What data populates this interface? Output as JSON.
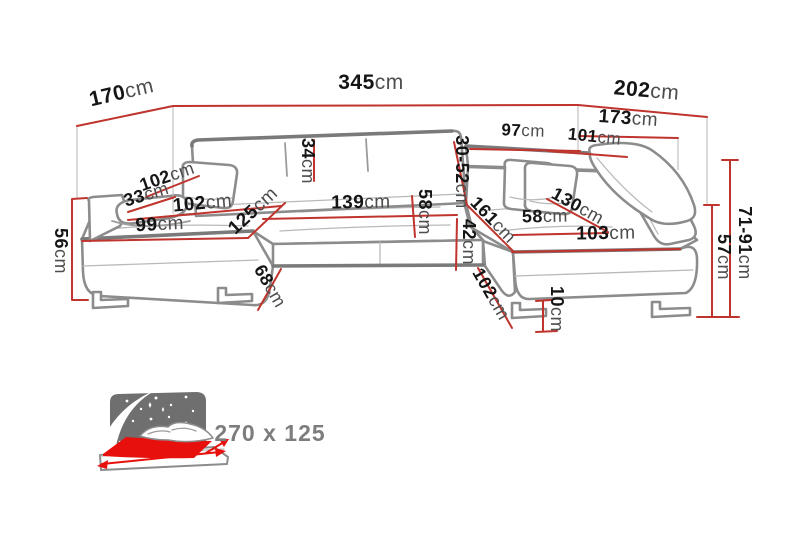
{
  "diagram": {
    "title": "corner-sofa-dimension-diagram",
    "colors": {
      "dimension_red": "#c0342e",
      "sofa_line_gray": "#8c8c8c",
      "bed_red": "#e8100c",
      "headboard_gray": "#6f6f6f",
      "label_black": "#151515",
      "bed_label_gray": "#7d7d7d"
    },
    "icons": {
      "bed": "sleeping-function-bed-icon",
      "stars": "night-stars-icon",
      "moon": "crescent-moon-icon"
    },
    "dims": {
      "d170": {
        "num": "170",
        "unit": "cm"
      },
      "d345": {
        "num": "345",
        "unit": "cm"
      },
      "d202": {
        "num": "202",
        "unit": "cm"
      },
      "d173": {
        "num": "173",
        "unit": "cm"
      },
      "d97": {
        "num": "97",
        "unit": "cm"
      },
      "d101": {
        "num": "101",
        "unit": "cm"
      },
      "d34": {
        "num": "34",
        "unit": "cm"
      },
      "d3052": {
        "num": "30-52",
        "unit": "cm"
      },
      "d58mid": {
        "num": "58",
        "unit": "cm"
      },
      "d42": {
        "num": "42",
        "unit": "cm"
      },
      "d139": {
        "num": "139",
        "unit": "cm"
      },
      "d102seat": {
        "num": "102",
        "unit": "cm"
      },
      "d99": {
        "num": "99",
        "unit": "cm"
      },
      "d125": {
        "num": "125",
        "unit": "cm"
      },
      "d33": {
        "num": "33",
        "unit": "cm"
      },
      "d102arm": {
        "num": "102",
        "unit": "cm"
      },
      "d56": {
        "num": "56",
        "unit": "cm"
      },
      "d161": {
        "num": "161",
        "unit": "cm"
      },
      "d130": {
        "num": "130",
        "unit": "cm"
      },
      "d58right": {
        "num": "58",
        "unit": "cm"
      },
      "d103": {
        "num": "103",
        "unit": "cm"
      },
      "d102br": {
        "num": "102",
        "unit": "cm"
      },
      "d10": {
        "num": "10",
        "unit": "cm"
      },
      "d68": {
        "num": "68",
        "unit": "cm"
      },
      "d57": {
        "num": "57",
        "unit": "cm"
      },
      "d7191": {
        "num": "71-91",
        "unit": "cm"
      }
    },
    "bed": {
      "size_label": "270 x 125"
    }
  }
}
